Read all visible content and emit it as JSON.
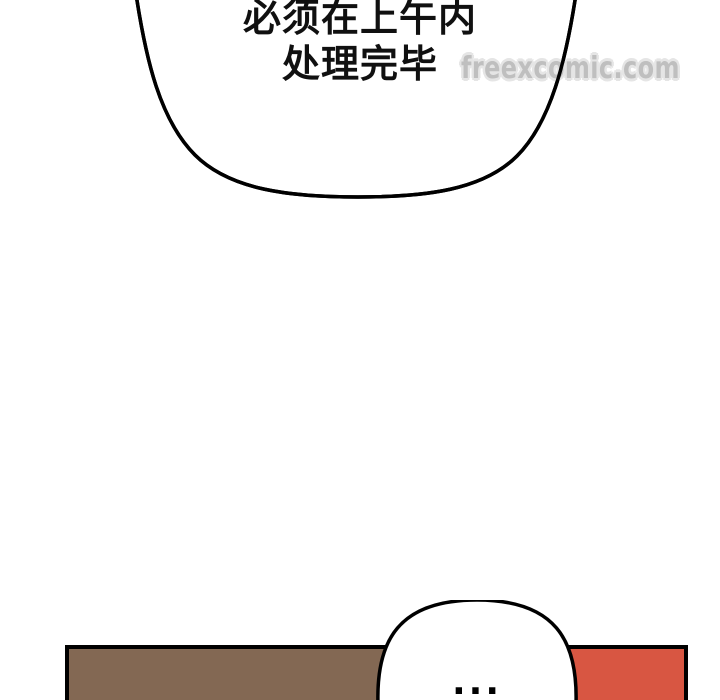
{
  "page": {
    "background_color": "#ffffff"
  },
  "watermark": {
    "text": "freexcomic.com",
    "fill_color": "#bfbfbf",
    "outline_color": "#e5e5e5"
  },
  "top_speech_bubble": {
    "line1": "必须在上午内",
    "line2": "处理完毕",
    "fill_color": "#ffffff",
    "stroke_color": "#000000",
    "text_color": "#101010"
  },
  "bottom_panel": {
    "left_fill_color": "#836853",
    "right_fill_color": "#d85642",
    "border_color": "#000000"
  },
  "bottom_speech_bubble": {
    "text": "...",
    "fill_color": "#ffffff",
    "stroke_color": "#000000",
    "text_color": "#000000"
  }
}
